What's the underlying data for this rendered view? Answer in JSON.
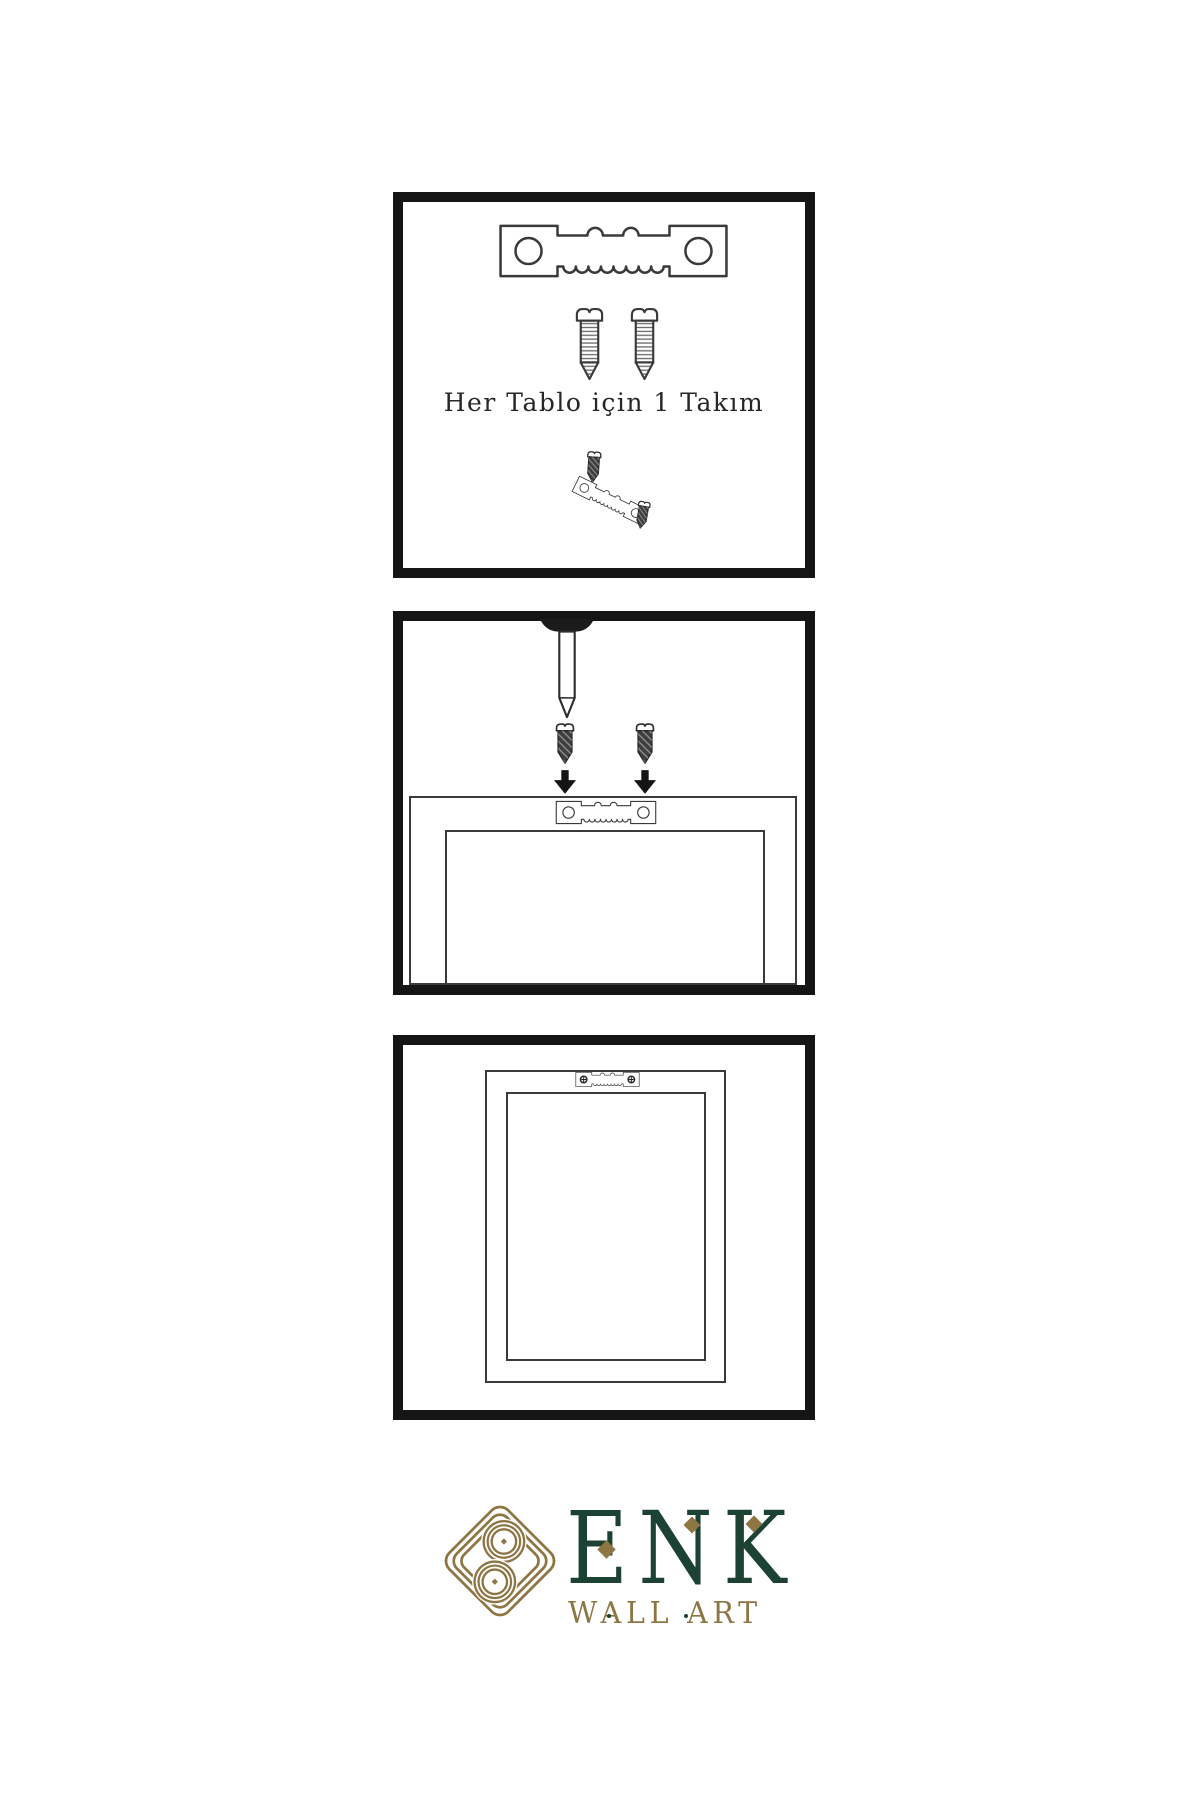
{
  "theme": {
    "page-bg": "#ffffff",
    "panel-border": "#151515",
    "line": "#3a3a3a",
    "screw-dark": "#3f3f3f",
    "nail-head": "#1b1b1b",
    "arrow": "#141414",
    "text": "#272727",
    "logo-green": "#1c4233",
    "logo-gold": "#8d7544"
  },
  "panels": [
    {
      "id": "hardware-kit",
      "caption": "Her Tablo için 1 Takım"
    },
    {
      "id": "screw-hanger-to-frame"
    },
    {
      "id": "frame-back-finished"
    }
  ],
  "icons": {
    "sawtooth-hanger": "metal plate with two holes and serrated bottom edge",
    "screw-light": "threaded screw outline",
    "screw-dark": "dark pointed screw",
    "nail": "wall nail from above",
    "arrow-down": "solid downward arrow",
    "knot": "interlaced gold knot mark"
  },
  "logo": {
    "title": "ENK",
    "subtitle": "WALL ART"
  }
}
